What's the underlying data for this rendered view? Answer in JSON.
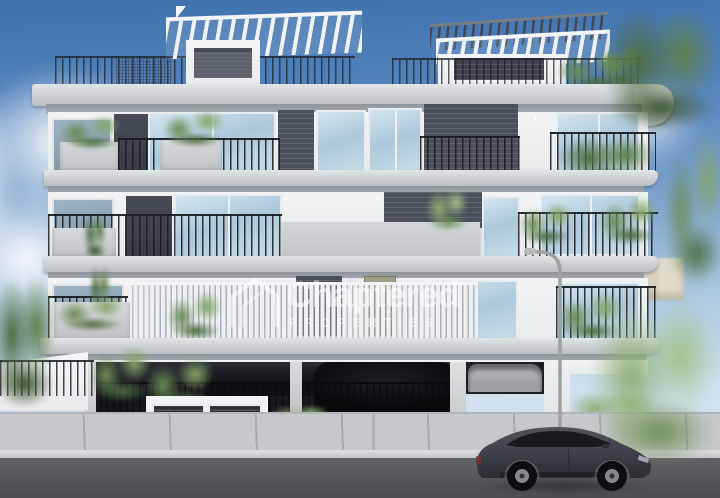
{
  "meta": {
    "type": "architectural-render",
    "description": "3D exterior rendering of a modern four-storey apartment building with rooftop pergolas, planted glass balconies, a street-level parking garage, a street lamp, sidewalk and a dark grey sportback car passing on the road",
    "canvas": {
      "width": 720,
      "height": 498
    }
  },
  "watermark": {
    "brand": "Chaptered",
    "subtitle": "PROPERTIES",
    "icon": "house-outline-icon",
    "color": "#ffffff",
    "opacity": 0.55
  },
  "palette": {
    "sky_top": "#3e71ad",
    "sky_bottom": "#dde9f2",
    "cloud": "#ffffff",
    "facade_white": "#f1f3f4",
    "slab_concrete": "#cbd0d3",
    "soffit_shadow": "#8d959b",
    "accent_brick": "#49505a",
    "glass_blue": "#adc8da",
    "railing_black": "#181b20",
    "plant_green": "#6a8b54",
    "door_olive": "#9c9c84",
    "garage_dark": "#17191d",
    "sidewalk_grey": "#c6c9cb",
    "road_asphalt": "#4b4e52",
    "car_grey": "#41454c",
    "lamp_pole": "#9aa39f",
    "distant_building_beige": "#e0dacb"
  },
  "scene": {
    "objects": [
      "sky",
      "clouds",
      "rooftop-pergola-left",
      "rooftop-pergola-right",
      "roof-terrace-railing",
      "roof-slab",
      "balcony-floor-3",
      "balcony-floor-2",
      "balcony-floor-1",
      "concrete-parapet",
      "balcony-planters",
      "balcony-plants",
      "ground-floor-garage",
      "garage-gate",
      "car-inside-garage",
      "black-suv-in-garage",
      "silver-car-in-carport",
      "utility-louver-boxes",
      "garden-bushes",
      "boundary-wall",
      "distant-buildings",
      "street-lamp",
      "driveway",
      "sidewalk",
      "curb",
      "road",
      "foreground-sportback-car",
      "foreground-tree-right",
      "tree-top-right",
      "tree-left"
    ],
    "vehicles": {
      "foreground_car": "dark grey sportback driving right",
      "garage_cars": [
        "dark sedan",
        "black SUV behind gate",
        "silver car in right carport"
      ]
    }
  }
}
